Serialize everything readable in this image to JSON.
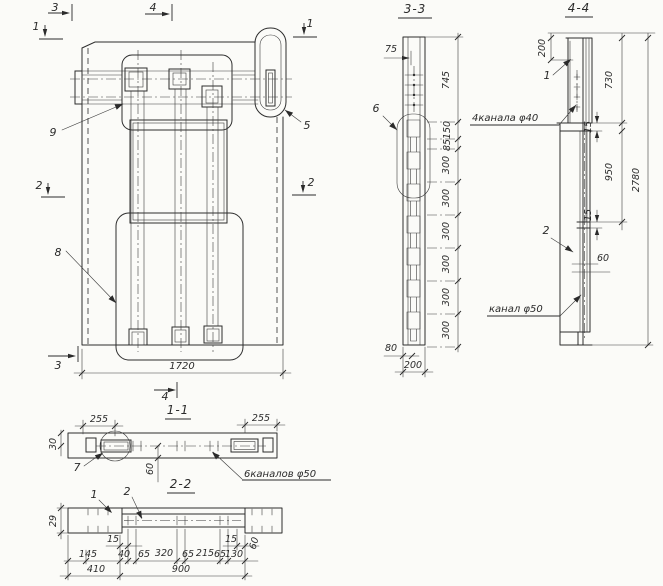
{
  "palette": {
    "paper": "#fbfbf8",
    "ink": "#2b2b2b"
  },
  "plan": {
    "cut_markers": {
      "top_3": "3",
      "top_4": "4",
      "left_1": "1",
      "right_1": "1",
      "left_2": "2",
      "right_2": "2",
      "bottom_3": "3",
      "bottom_4": "4"
    },
    "callouts": {
      "loop_top": "9",
      "corner_detail": "5",
      "loop_bottom": "8"
    },
    "dims": {
      "overall_width": "1720"
    }
  },
  "section_3_3": {
    "title": "3-3",
    "callout_channel_chain": "6",
    "dims": {
      "edge_offset": "75",
      "top_segment": "745",
      "seg_150": "150",
      "seg_85": "85",
      "channel_spacings": [
        "300",
        "300",
        "300",
        "300",
        "300",
        "300"
      ],
      "bottom_offset": "80",
      "thickness": "200"
    }
  },
  "section_4_4": {
    "title": "4-4",
    "callout_1": "1",
    "callout_2": "2",
    "labels": {
      "channels_40": "4канала φ40",
      "channel_50": "канал φ50"
    },
    "dims": {
      "top_offset": "200",
      "upper_part": "730",
      "joint_gap_top": "15",
      "middle_part": "950",
      "joint_gap_bottom": "15",
      "channel_width": "60",
      "overall_height": "2780"
    }
  },
  "section_1_1": {
    "title": "1-1",
    "callout_detail": "7",
    "labels": {
      "channels_50": "6каналов φ50"
    },
    "dims": {
      "left_end": "255",
      "right_end": "255",
      "edge_offset": "30",
      "channel_depth": "60"
    }
  },
  "section_2_2": {
    "title": "2-2",
    "callout_1": "1",
    "callout_2": "2",
    "dims": {
      "flange_thickness": "29",
      "inset_left": "15",
      "inset_right": "15",
      "web_offset": "60",
      "row_small": [
        "145",
        "40",
        "65",
        "320",
        "65",
        "215",
        "65",
        "130"
      ],
      "row_main": [
        "410",
        "900"
      ]
    }
  }
}
